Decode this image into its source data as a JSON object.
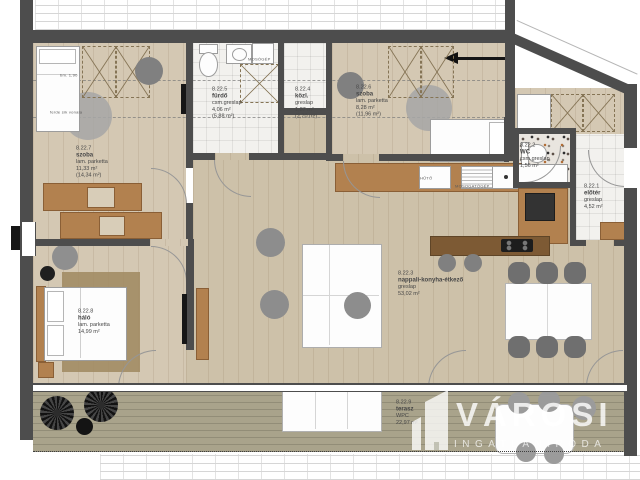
{
  "rooms": [
    {
      "number": "8.22.1",
      "name": "előtér",
      "floor": "greslap",
      "area": "4,52 m²",
      "area_total": ""
    },
    {
      "number": "8.22.2",
      "name": "WC",
      "floor": "csm.greslap",
      "area": "1,56 m²",
      "area_total": ""
    },
    {
      "number": "8.22.3",
      "name": "nappali-konyha-étkező",
      "floor": "greslap",
      "area": "53,02 m²",
      "area_total": ""
    },
    {
      "number": "8.22.4",
      "name": "közl.",
      "floor": "greslap",
      "area": "1,87 m²",
      "area_total": "(2,70 m²)"
    },
    {
      "number": "8.22.5",
      "name": "fürdő",
      "floor": "csm.greslap",
      "area": "4,06 m²",
      "area_total": "(5,88 m²)"
    },
    {
      "number": "8.22.6",
      "name": "szoba",
      "floor": "lam. parketta",
      "area": "8,28 m²",
      "area_total": "(11,96 m²)"
    },
    {
      "number": "8.22.7",
      "name": "szoba",
      "floor": "lam. parketta",
      "area": "11,33 m²",
      "area_total": "(14,34 m²)"
    },
    {
      "number": "8.22.8",
      "name": "háló",
      "floor": "lam. parketta",
      "area": "14,99 m²",
      "area_total": ""
    },
    {
      "number": "8.22.9",
      "name": "terasz",
      "floor": "WPC",
      "area": "22,97 m²",
      "area_total": ""
    }
  ],
  "annotations": {
    "ceiling_height": "bm. 1,90",
    "slope_line": "ferde sík vonala"
  },
  "appliances": {
    "washing_machine": "MOSÓGÉP",
    "fridge": "HŰTŐ",
    "dishwasher": "MOSOGATÓGÉP"
  },
  "watermark": {
    "brand": "VÁROSI",
    "subtitle": "INGATLANIRODA"
  },
  "colors": {
    "wall": "#4d4d4d",
    "wood_floor": "#d4c8b3",
    "living_floor": "#cdc1a9",
    "cabinet_wood": "#b2814f",
    "deck": "#a9a38b",
    "tile": "#f2f1ee",
    "watermark": "#ffffff"
  }
}
